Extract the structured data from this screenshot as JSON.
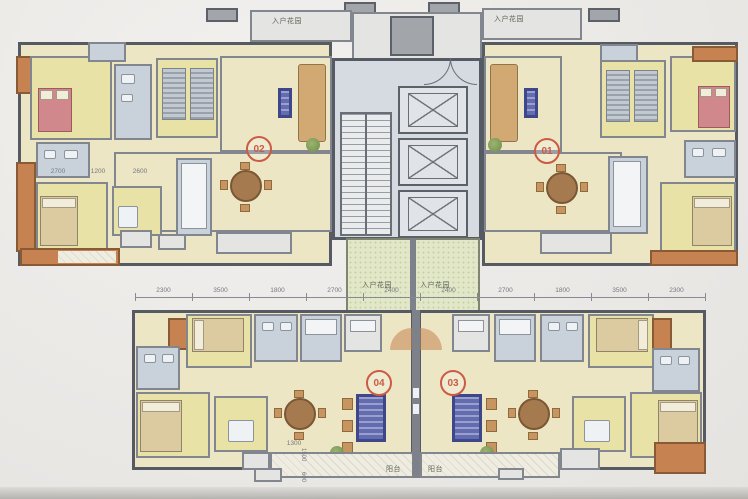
{
  "meta": {
    "title": "Residential tower typical floor plan (photo)",
    "description": "Architectural floor plan with four apartment units around a central elevator/stair core and entry gardens"
  },
  "palette": {
    "paper": "#efeeec",
    "wall": "#565a63",
    "bedroom_yellow": "#e9e2a4",
    "living_beige": "#ece6c3",
    "wet_room_blue": "#c9d2da",
    "core_gray": "#d5dbe1",
    "balcony_orange": "#c8824f",
    "garden_green": "#e2e7c8",
    "bed_pink": "#d3878c",
    "wood_brown": "#a87a4d",
    "rug_blue": "#646cb4",
    "badge_orange": "#cf5a43",
    "plant_green": "#7fa05f"
  },
  "units": [
    {
      "id": "unit-02",
      "number": "02"
    },
    {
      "id": "unit-01",
      "number": "01"
    },
    {
      "id": "unit-04",
      "number": "04"
    },
    {
      "id": "unit-03",
      "number": "03"
    }
  ],
  "labels": {
    "entry_garden": "入户花园",
    "balcony": "阳台"
  },
  "icons": {
    "elevator": "elevator-x-icon",
    "stairs": "stairs-icon"
  },
  "dimensions": {
    "top_row": [
      "2300",
      "3500",
      "1800",
      "2700",
      "2400",
      "2400",
      "2700",
      "1800",
      "3500",
      "2300"
    ],
    "interior_left": [
      "2700",
      "1200",
      "2600"
    ],
    "balcony_width": "1300",
    "vertical": [
      "1500",
      "600"
    ]
  }
}
